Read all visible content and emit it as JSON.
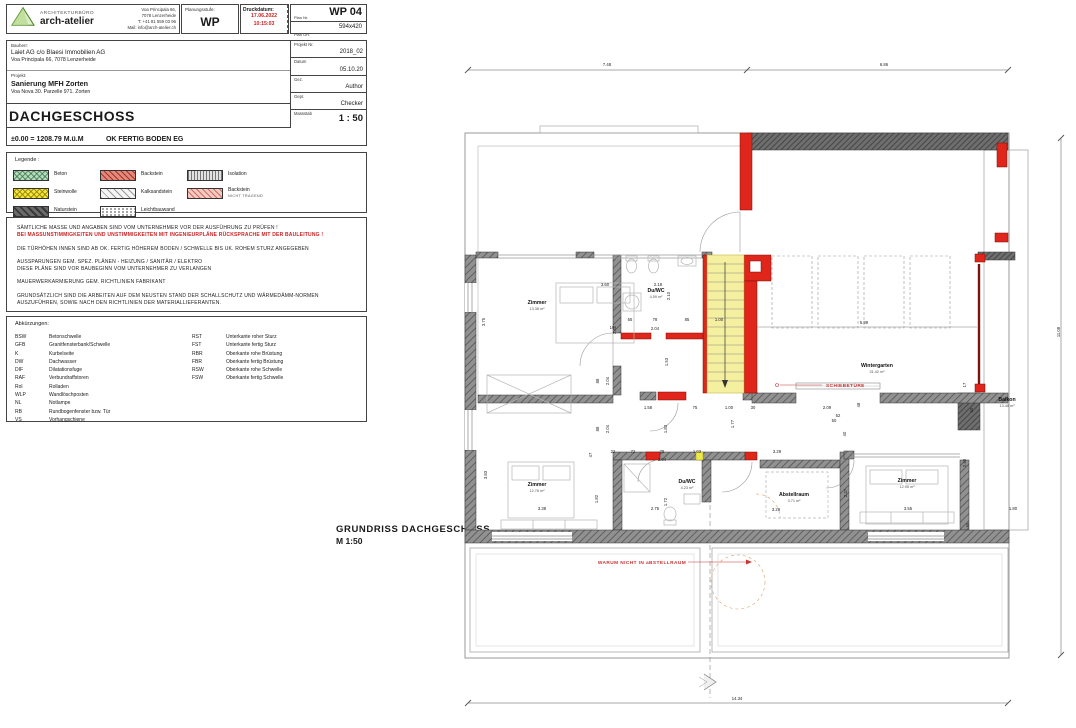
{
  "title_block": {
    "firm": {
      "label": "ARCHITEKTURBÜRO",
      "name": "arch-atelier",
      "address_lines": [
        "Voa Principala 66,",
        "7078 Lenzerheide",
        "T: +41 81 559 03 96",
        "Mail: info@arch-atelier.ch"
      ]
    },
    "planungsstufe": {
      "label": "Planungsstufe:",
      "value": "WP"
    },
    "druckdatum": {
      "label": "Druckdatum:",
      "date": "17.06.2022",
      "time": "10:15:03"
    },
    "plan_nr": {
      "label": "Plan Nr.",
      "value": "WP 04"
    },
    "plan_gr": {
      "label": "Plan GR.",
      "value": "594x420"
    }
  },
  "project_block": {
    "bauherr_label": "Bauherr:",
    "bauherr_name": "Laiet AG c/o Blaesi Immobilien AG",
    "bauherr_address": "Voa Principala 66, 7078 Lenzerheide",
    "projekt_label": "Projekt:",
    "projekt_name": "Sanierung MFH Zorten",
    "projekt_address": "Voa Nova 30. Parzelle 971. Zorten",
    "floor_title": "DACHGESCHOSS",
    "elevation_left": "±0.00 = 1208.79 M.ü.M",
    "elevation_right": "OK FERTIG BODEN EG",
    "meta": [
      {
        "label": "Projekt Nr.",
        "value": "2018_02"
      },
      {
        "label": "Datum",
        "value": "05.10.20"
      },
      {
        "label": "Gez.",
        "value": "Author"
      },
      {
        "label": "Gepr.",
        "value": "Checker"
      }
    ],
    "massstab": {
      "label": "Massstab",
      "value": "1 : 50"
    }
  },
  "legend": {
    "title": "Legende :",
    "items": [
      {
        "label": "Beton",
        "pattern": "beton"
      },
      {
        "label": "Backstein",
        "pattern": "backstein"
      },
      {
        "label": "Isolation",
        "pattern": "isolation"
      },
      {
        "label": "Steinwolle",
        "pattern": "steinwolle"
      },
      {
        "label": "Kalksandstein",
        "pattern": "kalksandstein"
      },
      {
        "label": "Backstein",
        "sub": "NICHT TRAGEND",
        "pattern": "backstein-nt"
      },
      {
        "label": "Naturstein",
        "pattern": "naturstein"
      },
      {
        "label": "Leichtbauwand",
        "pattern": "leichtbau"
      }
    ]
  },
  "notes": {
    "lines": [
      {
        "text": "SÄMTLICHE MASSE UND ANGABEN SIND VOM UNTERNEHMER VOR DER AUSFÜHRUNG ZU PRÜFEN !"
      },
      {
        "text": "BEI MASSUNSTIMMIGKEITEN UND UNSTIMMIGKEITEN MIT INGENIEURPLÄNE RÜCKSPRACHE MIT DER BAULEITUNG !",
        "red": true
      },
      {
        "text": "DIE TÜRHÖHEN INNEN SIND AB OK. FERTIG HÖHEREM BODEN / SCHWELLE BIS UK. ROHEM STURZ ANGEGEBEN",
        "gap": true
      },
      {
        "text": "AUSSPARUNGEN GEM. SPEZ. PLÄNEN - HEIZUNG / SANITÄR / ELEKTRO",
        "gap": true
      },
      {
        "text": "DIESE PLÄNE SIND VOR BAUBEGINN VOM UNTERNEHMER ZU VERLANGEN"
      },
      {
        "text": "MAUERWERKARMIERUNG GEM. RICHTLINIEN FABRIKANT",
        "gap": true
      },
      {
        "text": "GRUNDSÄTZLICH SIND DIE ARBEITEN AUF DEM NEUSTEN STAND DER SCHALLSCHUTZ UND WÄRMEDÄMM-NORMEN",
        "gap": true
      },
      {
        "text": "AUSZUFÜHREN, SOWIE NACH DEN RICHTLINIEN DER MATERIALLIEFERANTEN."
      }
    ]
  },
  "abbreviations": {
    "title": "Abkürzungen:",
    "left": [
      {
        "a": "BSW",
        "t": "Betonschwelle"
      },
      {
        "a": "GFB",
        "t": "Granitfensterbank/Schwelle"
      },
      {
        "a": "K",
        "t": "Kurbelseite"
      },
      {
        "a": "DW",
        "t": "Dachwasser"
      },
      {
        "a": "DIF",
        "t": "Dilatationsfuge"
      },
      {
        "a": "RAF",
        "t": "Verbundraffstoren"
      },
      {
        "a": "Rol",
        "t": "Rolladen"
      },
      {
        "a": "WLP",
        "t": "Wandlöschposten"
      },
      {
        "a": "NL",
        "t": "Notlampe"
      },
      {
        "a": "RB",
        "t": "Rundbogenfenster bzw. Tür"
      },
      {
        "a": "VS",
        "t": "Vorhangschiene"
      }
    ],
    "right": [
      {
        "a": "RST",
        "t": "Unterkante roher Sturz"
      },
      {
        "a": "FST",
        "t": "Unterkante fertig Sturz"
      },
      {
        "a": "RBR",
        "t": "Oberkante rohe Brüstung"
      },
      {
        "a": "FBR",
        "t": "Oberkante fertig Brüstung"
      },
      {
        "a": "RSW",
        "t": "Oberkante rohe Schwelle"
      },
      {
        "a": "FSW",
        "t": "Oberkante fertig Schwelle"
      }
    ]
  },
  "plan": {
    "caption_line1": "GRUNDRISS  DACHGESCHOSS",
    "caption_line2": "M 1:50",
    "annotations": {
      "schiebetuere": "SCHIEBETÜRE",
      "warum": "WARUM NICHT IN aBSTELLRAUM"
    },
    "rooms": [
      {
        "name": "Zimmer",
        "area": "13.38 m²",
        "x": 81,
        "y": 254
      },
      {
        "name": "Du/WC",
        "area": "4.59 m²",
        "x": 200,
        "y": 242
      },
      {
        "name": "Wintergarten",
        "area": "31.42 m²",
        "x": 421,
        "y": 317
      },
      {
        "name": "Balkon",
        "area": "13.48 m²",
        "x": 551,
        "y": 351
      },
      {
        "name": "Zimmer",
        "area": "12.76 m²",
        "x": 81,
        "y": 436
      },
      {
        "name": "Du/WC",
        "area": "4.23 m²",
        "x": 231,
        "y": 433
      },
      {
        "name": "Abstellraum",
        "area": "3.71 m²",
        "x": 338,
        "y": 446
      },
      {
        "name": "Zimmer",
        "area": "12.95 m²",
        "x": 451,
        "y": 432
      }
    ],
    "dimensions": [
      {
        "t": "7.48",
        "x": 151,
        "y": 16
      },
      {
        "t": "6.86",
        "x": 428,
        "y": 16
      },
      {
        "t": "11.08",
        "x": 604,
        "y": 282,
        "r": 1
      },
      {
        "t": "14.34",
        "x": 281,
        "y": 650
      },
      {
        "t": "3.60",
        "x": 149,
        "y": 236
      },
      {
        "t": "2.18",
        "x": 202,
        "y": 236
      },
      {
        "t": "3.75",
        "x": 29,
        "y": 272,
        "r": 1
      },
      {
        "t": "2.41",
        "x": 160,
        "y": 280,
        "r": 1
      },
      {
        "t": "2.10",
        "x": 214,
        "y": 246,
        "r": 1
      },
      {
        "t": "55",
        "x": 174,
        "y": 271
      },
      {
        "t": "78",
        "x": 199,
        "y": 271
      },
      {
        "t": "85",
        "x": 231,
        "y": 271
      },
      {
        "t": "1.00",
        "x": 263,
        "y": 271
      },
      {
        "t": "10",
        "x": 156,
        "y": 279
      },
      {
        "t": "2.04",
        "x": 199,
        "y": 280
      },
      {
        "t": "1.53",
        "x": 212,
        "y": 312,
        "r": 1
      },
      {
        "t": "88",
        "x": 143,
        "y": 331,
        "r": 1
      },
      {
        "t": "2.04",
        "x": 153,
        "y": 331,
        "r": 1
      },
      {
        "t": "5.99",
        "x": 408,
        "y": 274
      },
      {
        "t": "1.58",
        "x": 192,
        "y": 359
      },
      {
        "t": "75",
        "x": 239,
        "y": 359
      },
      {
        "t": "1.00",
        "x": 273,
        "y": 359
      },
      {
        "t": "30",
        "x": 297,
        "y": 359
      },
      {
        "t": "2.09",
        "x": 371,
        "y": 359
      },
      {
        "t": "48",
        "x": 404,
        "y": 355,
        "r": 1
      },
      {
        "t": "52",
        "x": 382,
        "y": 367
      },
      {
        "t": "40",
        "x": 390,
        "y": 384,
        "r": 1
      },
      {
        "t": "50",
        "x": 378,
        "y": 372
      },
      {
        "t": "17",
        "x": 510,
        "y": 335,
        "r": 1
      },
      {
        "t": "60",
        "x": 517,
        "y": 360,
        "r": 1
      },
      {
        "t": "1.83",
        "x": 211,
        "y": 379,
        "r": 1
      },
      {
        "t": "1.77",
        "x": 278,
        "y": 374,
        "r": 1
      },
      {
        "t": "88",
        "x": 143,
        "y": 379,
        "r": 1
      },
      {
        "t": "2.04",
        "x": 153,
        "y": 379,
        "r": 1
      },
      {
        "t": "22",
        "x": 157,
        "y": 403
      },
      {
        "t": "72",
        "x": 177,
        "y": 403
      },
      {
        "t": "78",
        "x": 206,
        "y": 403
      },
      {
        "t": "1.03",
        "x": 241,
        "y": 403
      },
      {
        "t": "2.04",
        "x": 206,
        "y": 411
      },
      {
        "t": "3.29",
        "x": 321,
        "y": 403
      },
      {
        "t": "47",
        "x": 136,
        "y": 405,
        "r": 1
      },
      {
        "t": "3.83",
        "x": 31,
        "y": 425,
        "r": 1
      },
      {
        "t": "1.82",
        "x": 142,
        "y": 449,
        "r": 1
      },
      {
        "t": "1.72",
        "x": 211,
        "y": 452,
        "r": 1
      },
      {
        "t": "2.75",
        "x": 199,
        "y": 460
      },
      {
        "t": "3.38",
        "x": 86,
        "y": 460
      },
      {
        "t": "3.29",
        "x": 320,
        "y": 461
      },
      {
        "t": "2.37",
        "x": 391,
        "y": 443,
        "r": 1
      },
      {
        "t": "3.55",
        "x": 452,
        "y": 460
      },
      {
        "t": "2.40",
        "x": 510,
        "y": 413,
        "r": 1
      },
      {
        "t": "65",
        "x": 513,
        "y": 475,
        "r": 1
      },
      {
        "t": "1.80",
        "x": 557,
        "y": 460
      }
    ]
  },
  "colors": {
    "backstein_red": "#e0251b",
    "annotation_red": "#cc3333",
    "druckdatum_red": "#cc2222",
    "stair_yellow": "#f5f0a0",
    "beton_green": "#b7d9bd",
    "steinwolle_yellow": "#efe93f",
    "wall_gray": "#8d8d8d",
    "naturstein_gray": "#6a6a6a"
  }
}
